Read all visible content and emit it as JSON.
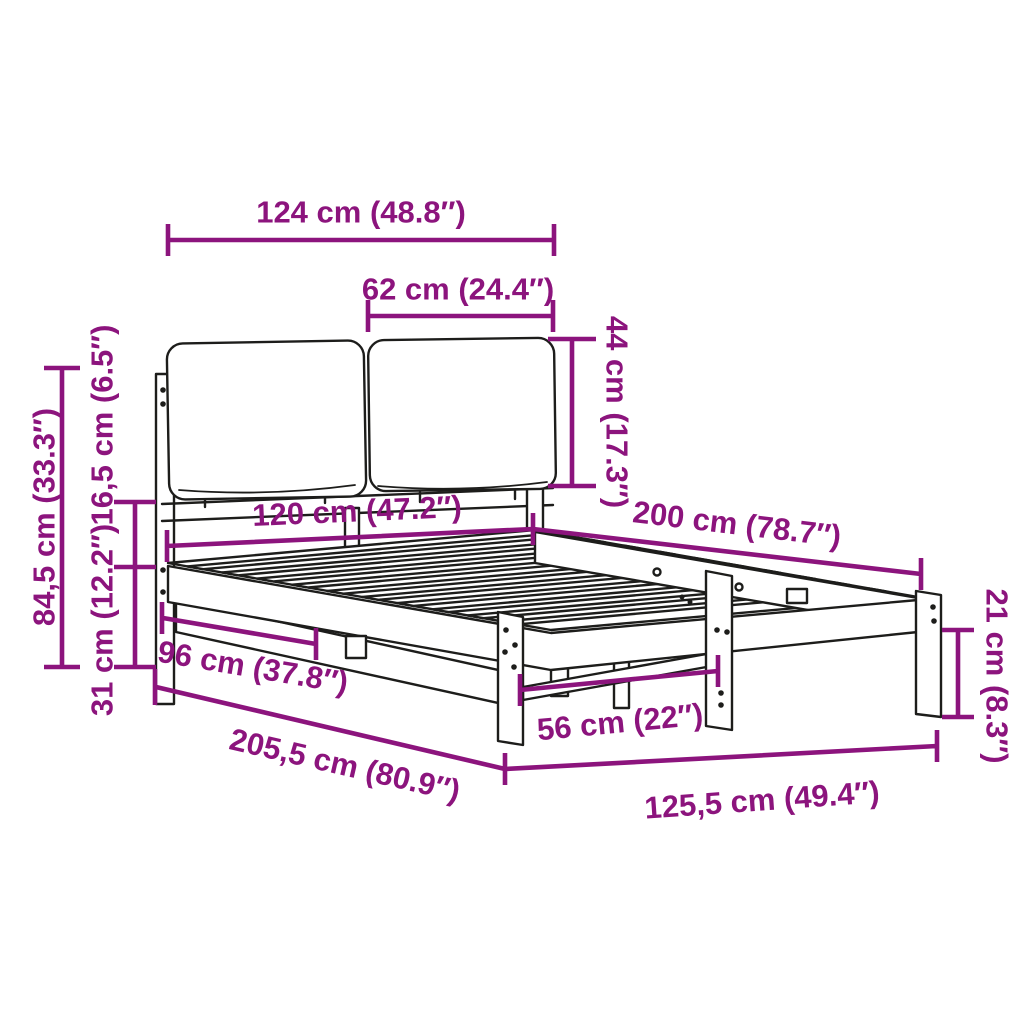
{
  "diagram": {
    "type": "product-dimension-diagram",
    "subject": "bed-frame-with-upholstered-headboard-cushions",
    "colors": {
      "accent": "#8c147d",
      "line_art": "#1d1d1b",
      "background": "#ffffff"
    },
    "units": {
      "primary": "cm",
      "secondary": "inch"
    },
    "dimensions": [
      {
        "id": "headboard-width",
        "cm": 124,
        "inch": 48.8,
        "label": "124 cm (48.8″)"
      },
      {
        "id": "cushion-width",
        "cm": 62,
        "inch": 24.4,
        "label": "62 cm (24.4″)"
      },
      {
        "id": "cushion-height",
        "cm": 44,
        "inch": 17.3,
        "label": "44 cm (17.3″)"
      },
      {
        "id": "headboard-height",
        "cm": 84.5,
        "inch": 33.3,
        "label": "84,5 cm (33.3″)"
      },
      {
        "id": "headboard-top-offset",
        "cm": 16.5,
        "inch": 6.5,
        "label": "16,5 cm (6.5″)"
      },
      {
        "id": "frame-height",
        "cm": 31,
        "inch": 12.2,
        "label": "31 cm (12.2″)"
      },
      {
        "id": "inner-width",
        "cm": 120,
        "inch": 47.2,
        "label": "120 cm (47.2″)"
      },
      {
        "id": "bed-length",
        "cm": 200,
        "inch": 78.7,
        "label": "200 cm (78.7″)"
      },
      {
        "id": "side-span",
        "cm": 96,
        "inch": 37.8,
        "label": "96 cm (37.8″)"
      },
      {
        "id": "total-length",
        "cm": 205.5,
        "inch": 80.9,
        "label": "205,5 cm (80.9″)"
      },
      {
        "id": "center-leg-spacing",
        "cm": 56,
        "inch": 22,
        "label": "56 cm (22″)"
      },
      {
        "id": "total-width",
        "cm": 125.5,
        "inch": 49.4,
        "label": "125,5 cm (49.4″)"
      },
      {
        "id": "leg-height",
        "cm": 21,
        "inch": 8.3,
        "label": "21 cm (8.3″)"
      }
    ]
  }
}
